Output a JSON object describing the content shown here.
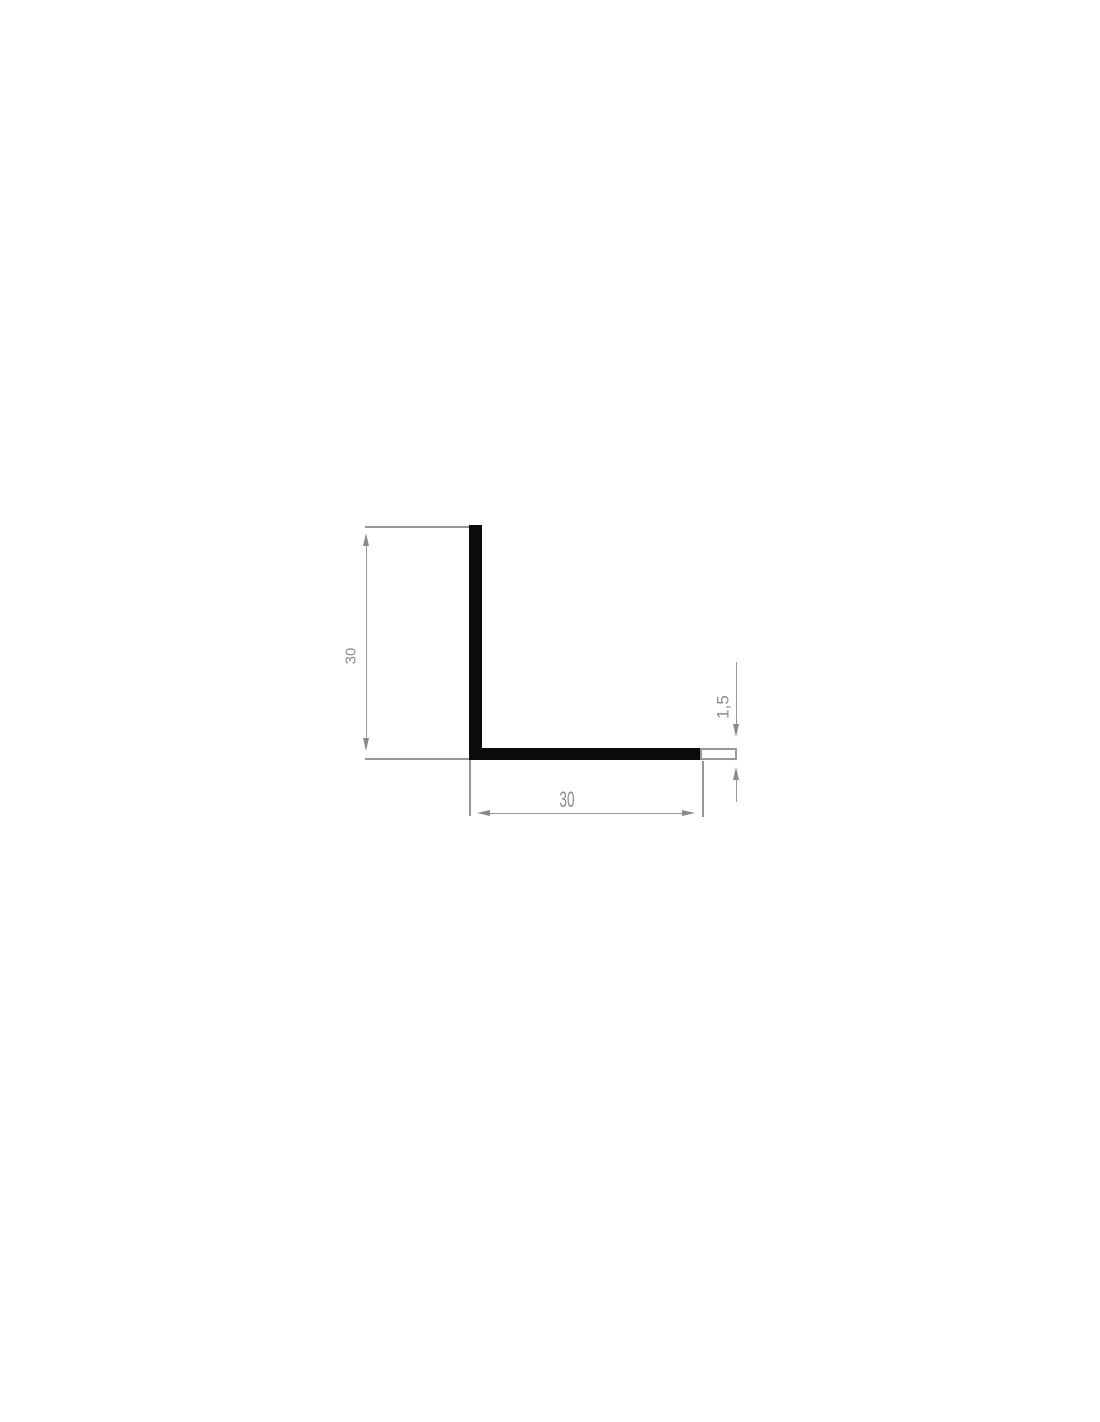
{
  "drawing": {
    "type": "L-angle profile cross-section technical drawing",
    "labels": {
      "height": "30",
      "width": "30",
      "thickness": "1,5"
    },
    "colors": {
      "profile": "#0b0b0b",
      "dimension_line": "#979797",
      "arrowhead": "#8a8a8a",
      "text": "#8c8c8c",
      "background": "#ffffff",
      "tip_outline_border": "#989898"
    }
  }
}
